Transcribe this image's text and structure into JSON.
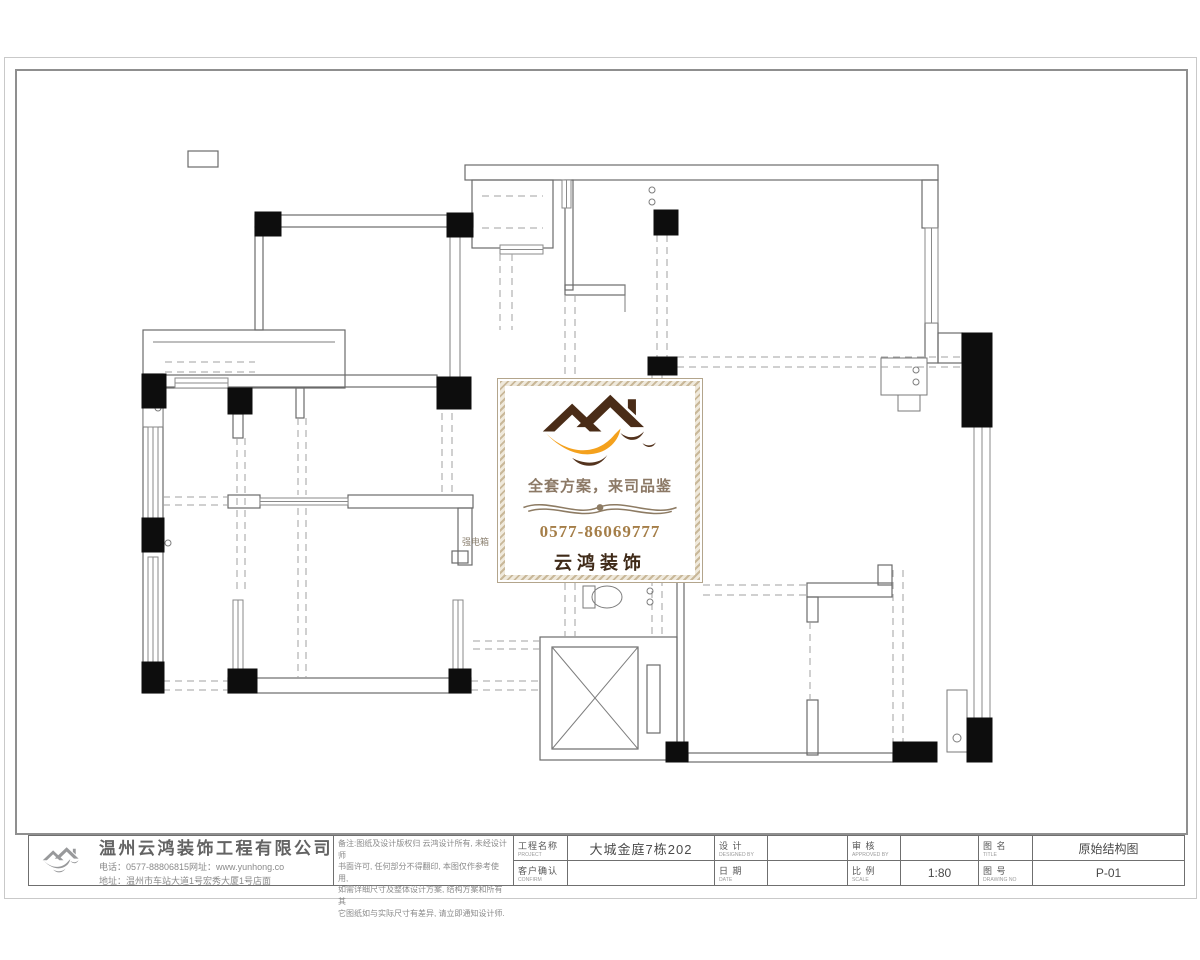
{
  "colors": {
    "column_black": "#0d0d0d",
    "wall_gray": "#6b6b6b",
    "brand_brown_dark": "#3f2a18",
    "brand_orange": "#f4a11d",
    "brand_tan": "#a57e48",
    "frame_gray": "#8f8f8f"
  },
  "watermark": {
    "slogan": "全套方案，来司品鉴",
    "phone": "0577-86069777",
    "brand": "云鸿装饰"
  },
  "titleblock": {
    "company": {
      "name": "温州云鸿装饰工程有限公司",
      "line1": "电话：0577-88806815网址：www.yunhong.co",
      "line2": "地址：温州市车站大道1号宏秀大厦1号店面"
    },
    "notes": [
      "备注:图纸及设计版权归 云鸿设计所有, 未经设计师",
      "书面许可, 任何部分不得翻印, 本图仅作参考使用,",
      "如需详细尺寸及整体设计方案, 结构方案和所有其",
      "它图纸如与实际尺寸有差异, 请立即通知设计师."
    ],
    "fields_top": [
      {
        "label": "工程名称",
        "sub": "PROJECT",
        "value": "大城金庭7栋202"
      },
      {
        "label": "设 计",
        "sub": "DESIGNED BY",
        "value": ""
      },
      {
        "label": "审 核",
        "sub": "APPROVED BY",
        "value": ""
      },
      {
        "label": "图 名",
        "sub": "TITLE",
        "value": "原始结构图"
      }
    ],
    "fields_bottom": [
      {
        "label": "客户确认",
        "sub": "CONFIRM",
        "value": ""
      },
      {
        "label": "日 期",
        "sub": "DATE",
        "value": ""
      },
      {
        "label": "比 例",
        "sub": "SCALE",
        "value": "1:80"
      },
      {
        "label": "图 号",
        "sub": "DRAWING NO",
        "value": "P-01"
      }
    ]
  },
  "plan": {
    "labels": [
      {
        "t": "强电箱",
        "x": 462,
        "y": 545
      }
    ],
    "columns": [
      [
        255,
        212,
        26,
        24
      ],
      [
        447,
        213,
        26,
        24
      ],
      [
        654,
        210,
        24,
        25
      ],
      [
        962,
        333,
        30,
        94
      ],
      [
        142,
        374,
        24,
        34
      ],
      [
        228,
        388,
        24,
        26
      ],
      [
        437,
        377,
        34,
        32
      ],
      [
        648,
        357,
        29,
        18
      ],
      [
        142,
        518,
        22,
        34
      ],
      [
        142,
        662,
        22,
        31
      ],
      [
        228,
        669,
        29,
        24
      ],
      [
        449,
        669,
        22,
        24
      ],
      [
        666,
        742,
        22,
        20
      ],
      [
        893,
        742,
        44,
        20
      ],
      [
        967,
        718,
        25,
        44
      ]
    ],
    "wall_rects": [
      [
        465,
        165,
        473,
        15
      ],
      [
        255,
        215,
        218,
        12
      ],
      [
        255,
        227,
        8,
        103
      ],
      [
        143,
        330,
        202,
        58
      ],
      [
        163,
        375,
        274,
        12
      ],
      [
        143,
        374,
        20,
        319
      ],
      [
        228,
        678,
        243,
        15
      ],
      [
        228,
        495,
        32,
        13
      ],
      [
        348,
        495,
        125,
        13
      ],
      [
        458,
        508,
        14,
        57
      ],
      [
        296,
        388,
        8,
        30
      ],
      [
        233,
        414,
        10,
        24
      ],
      [
        922,
        180,
        16,
        48
      ],
      [
        938,
        333,
        24,
        30
      ],
      [
        925,
        323,
        13,
        40
      ],
      [
        565,
        180,
        8,
        110
      ],
      [
        565,
        285,
        60,
        10
      ],
      [
        472,
        180,
        81,
        68
      ],
      [
        688,
        753,
        205,
        9
      ],
      [
        807,
        583,
        85,
        14
      ],
      [
        807,
        597,
        11,
        25
      ],
      [
        807,
        700,
        11,
        55
      ],
      [
        878,
        565,
        14,
        20
      ],
      [
        677,
        582,
        7,
        178
      ],
      [
        540,
        637,
        137,
        123
      ],
      [
        647,
        665,
        13,
        68
      ],
      [
        452,
        551,
        16,
        12
      ],
      [
        188,
        151,
        30,
        16
      ]
    ],
    "white_rects": [
      [
        881,
        358,
        46,
        37
      ],
      [
        898,
        395,
        22,
        16
      ],
      [
        947,
        690,
        20,
        62
      ],
      [
        143,
        405,
        20,
        22
      ],
      [
        583,
        586,
        12,
        22
      ]
    ],
    "windows": [
      [
        925,
        228,
        13,
        95
      ],
      [
        974,
        427,
        16,
        291
      ],
      [
        148,
        427,
        10,
        91
      ],
      [
        148,
        557,
        10,
        106
      ],
      [
        233,
        600,
        10,
        69
      ],
      [
        453,
        600,
        10,
        69
      ],
      [
        562,
        180,
        9,
        28
      ],
      [
        175,
        378,
        53,
        10
      ],
      [
        500,
        245,
        43,
        9
      ],
      [
        260,
        498,
        88,
        7
      ]
    ],
    "solid_lines": [
      [
        450,
        237,
        450,
        377
      ],
      [
        460,
        237,
        460,
        377
      ],
      [
        153,
        342,
        335,
        342
      ],
      [
        625,
        285,
        625,
        312
      ]
    ],
    "dashed_lines": [
      [
        163,
        681,
        228,
        681
      ],
      [
        163,
        690,
        228,
        690
      ],
      [
        471,
        681,
        540,
        681
      ],
      [
        471,
        690,
        540,
        690
      ],
      [
        165,
        362,
        255,
        362
      ],
      [
        165,
        372,
        255,
        372
      ],
      [
        163,
        497,
        228,
        497
      ],
      [
        163,
        505,
        228,
        505
      ],
      [
        298,
        418,
        298,
        495
      ],
      [
        306,
        418,
        306,
        495
      ],
      [
        298,
        508,
        298,
        678
      ],
      [
        306,
        508,
        306,
        678
      ],
      [
        237,
        438,
        237,
        590
      ],
      [
        245,
        438,
        245,
        590
      ],
      [
        442,
        413,
        442,
        495
      ],
      [
        452,
        413,
        452,
        495
      ],
      [
        565,
        295,
        565,
        637
      ],
      [
        575,
        295,
        575,
        637
      ],
      [
        652,
        375,
        652,
        637
      ],
      [
        662,
        375,
        662,
        637
      ],
      [
        657,
        235,
        657,
        357
      ],
      [
        667,
        235,
        667,
        357
      ],
      [
        677,
        357,
        962,
        357
      ],
      [
        677,
        367,
        962,
        367
      ],
      [
        703,
        585,
        807,
        585
      ],
      [
        703,
        595,
        807,
        595
      ],
      [
        893,
        570,
        893,
        742
      ],
      [
        903,
        570,
        903,
        742
      ],
      [
        810,
        622,
        810,
        700
      ],
      [
        473,
        641,
        540,
        641
      ],
      [
        473,
        649,
        540,
        649
      ],
      [
        500,
        254,
        500,
        330
      ],
      [
        512,
        254,
        512,
        330
      ],
      [
        482,
        196,
        543,
        196
      ],
      [
        482,
        228,
        543,
        228
      ]
    ],
    "circles": [
      [
        652,
        190,
        3
      ],
      [
        652,
        202,
        3
      ],
      [
        650,
        591,
        3
      ],
      [
        650,
        602,
        3
      ],
      [
        916,
        370,
        3
      ],
      [
        916,
        382,
        3
      ],
      [
        957,
        738,
        4
      ],
      [
        168,
        543,
        3
      ],
      [
        158,
        408,
        3
      ]
    ],
    "x_boxes": [
      [
        552,
        647,
        86,
        102
      ]
    ],
    "ellipses": [
      [
        607,
        597,
        15,
        11
      ]
    ]
  }
}
